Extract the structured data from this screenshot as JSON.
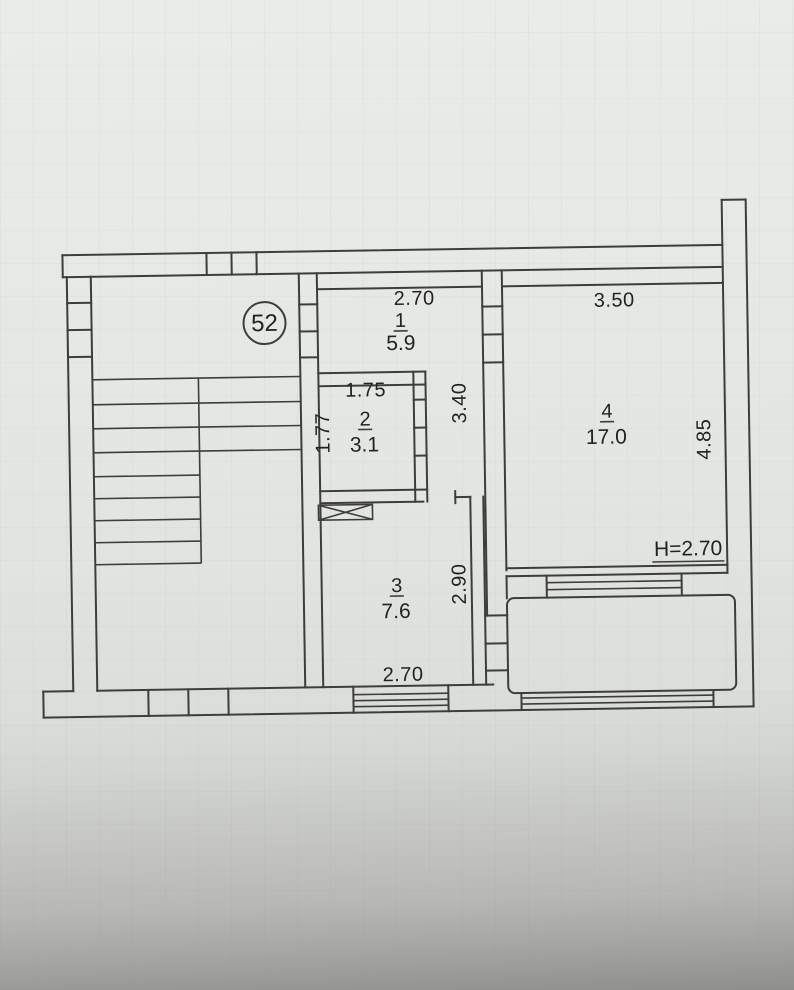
{
  "plan": {
    "unit_badge": "52",
    "rooms": [
      {
        "number": "1",
        "area": "5.9"
      },
      {
        "number": "2",
        "area": "3.1"
      },
      {
        "number": "3",
        "area": "7.6"
      },
      {
        "number": "4",
        "area": "17.0"
      }
    ],
    "dims": {
      "room1_width": "2.70",
      "room2_width": "1.75",
      "room2_depth": "1.77",
      "corridor_length": "3.40",
      "room3_depth": "2.90",
      "room3_width": "2.70",
      "room4_width": "3.50",
      "room4_depth": "4.85",
      "ceiling_height": "H=2.70"
    }
  }
}
